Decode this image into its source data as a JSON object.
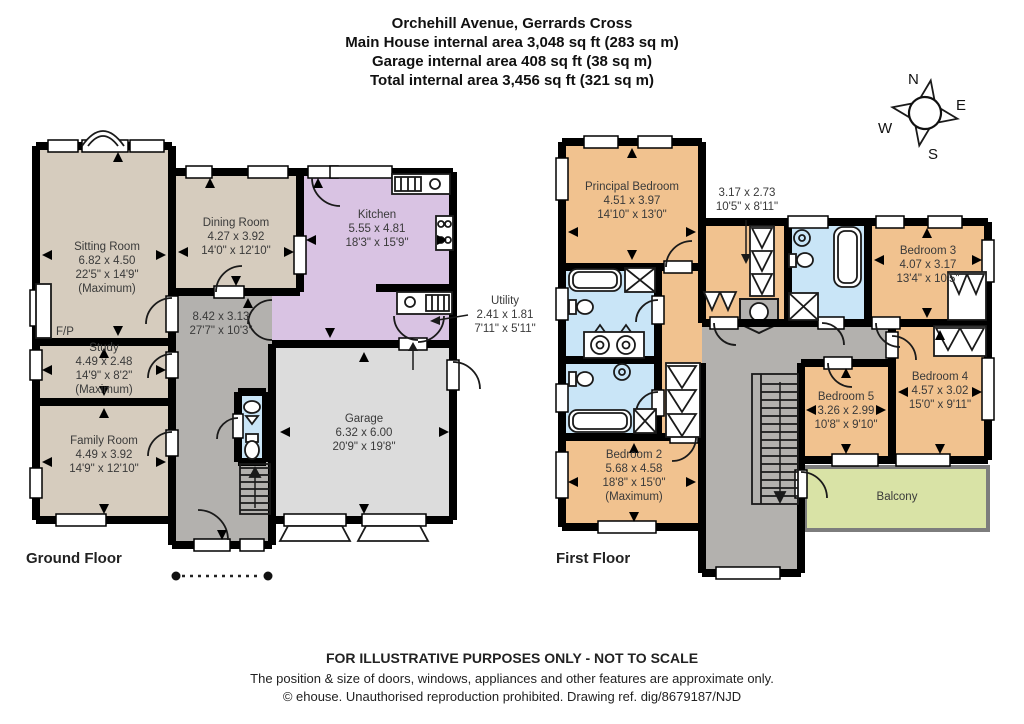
{
  "header": {
    "title": "Orchehill Avenue, Gerrards Cross",
    "line1": "Main House internal area 3,048 sq ft (283 sq m)",
    "line2": "Garage internal area 408 sq ft (38 sq m)",
    "line3": "Total internal area 3,456 sq ft (321 sq m)"
  },
  "compass": {
    "n": "N",
    "e": "E",
    "s": "S",
    "w": "W"
  },
  "ground_floor": {
    "label": "Ground Floor",
    "rooms": {
      "sitting": {
        "name": "Sitting Room",
        "metric": "6.82 x 4.50",
        "imperial": "22'5\" x 14'9\"",
        "note": "(Maximum)"
      },
      "dining": {
        "name": "Dining Room",
        "metric": "4.27 x 3.92",
        "imperial": "14'0\" x 12'10\""
      },
      "kitchen": {
        "name": "Kitchen",
        "metric": "5.55 x 4.81",
        "imperial": "18'3\" x 15'9\""
      },
      "hall": {
        "metric": "8.42 x 3.13",
        "imperial": "27'7\" x 10'3\""
      },
      "study": {
        "name": "Study",
        "metric": "4.49 x 2.48",
        "imperial": "14'9\" x 8'2\"",
        "note": "(Maximum)"
      },
      "family": {
        "name": "Family Room",
        "metric": "4.49 x 3.92",
        "imperial": "14'9\" x 12'10\""
      },
      "garage": {
        "name": "Garage",
        "metric": "6.32 x 6.00",
        "imperial": "20'9\" x 19'8\""
      },
      "utility": {
        "name": "Utility",
        "metric": "2.41 x 1.81",
        "imperial": "7'11\" x 5'11\""
      },
      "fireplace": "F/P"
    }
  },
  "first_floor": {
    "label": "First Floor",
    "rooms": {
      "principal": {
        "name": "Principal Bedroom",
        "metric": "4.51 x 3.97",
        "imperial": "14'10\" x 13'0\""
      },
      "dressing": {
        "metric": "3.17 x 2.73",
        "imperial": "10'5\" x 8'11\""
      },
      "bedroom2": {
        "name": "Bedroom 2",
        "metric": "5.68 x 4.58",
        "imperial": "18'8\" x 15'0\"",
        "note": "(Maximum)"
      },
      "bedroom3": {
        "name": "Bedroom 3",
        "metric": "4.07 x 3.17",
        "imperial": "13'4\" x 10'5\""
      },
      "bedroom4": {
        "name": "Bedroom 4",
        "metric": "4.57 x 3.02",
        "imperial": "15'0\" x 9'11\""
      },
      "bedroom5": {
        "name": "Bedroom 5",
        "metric": "3.26 x 2.99",
        "imperial": "10'8\" x 9'10\""
      },
      "balcony": {
        "name": "Balcony"
      }
    }
  },
  "footer": {
    "line1": "FOR ILLUSTRATIVE PURPOSES ONLY - NOT TO SCALE",
    "line2": "The position & size of doors, windows, appliances and other features are approximate only.",
    "line3": "© ehouse. Unauthorised reproduction prohibited. Drawing ref. dig/8679187/NJD"
  },
  "colors": {
    "wall": "#000000",
    "beige": "#d6ccbe",
    "purple": "#d9c3e3",
    "hall": "#b3b1ae",
    "garage": "#dcdcdc",
    "orange": "#f1c28f",
    "blue": "#c9e5f7",
    "green": "#d9e3a6",
    "text": "#3a3a3a"
  }
}
